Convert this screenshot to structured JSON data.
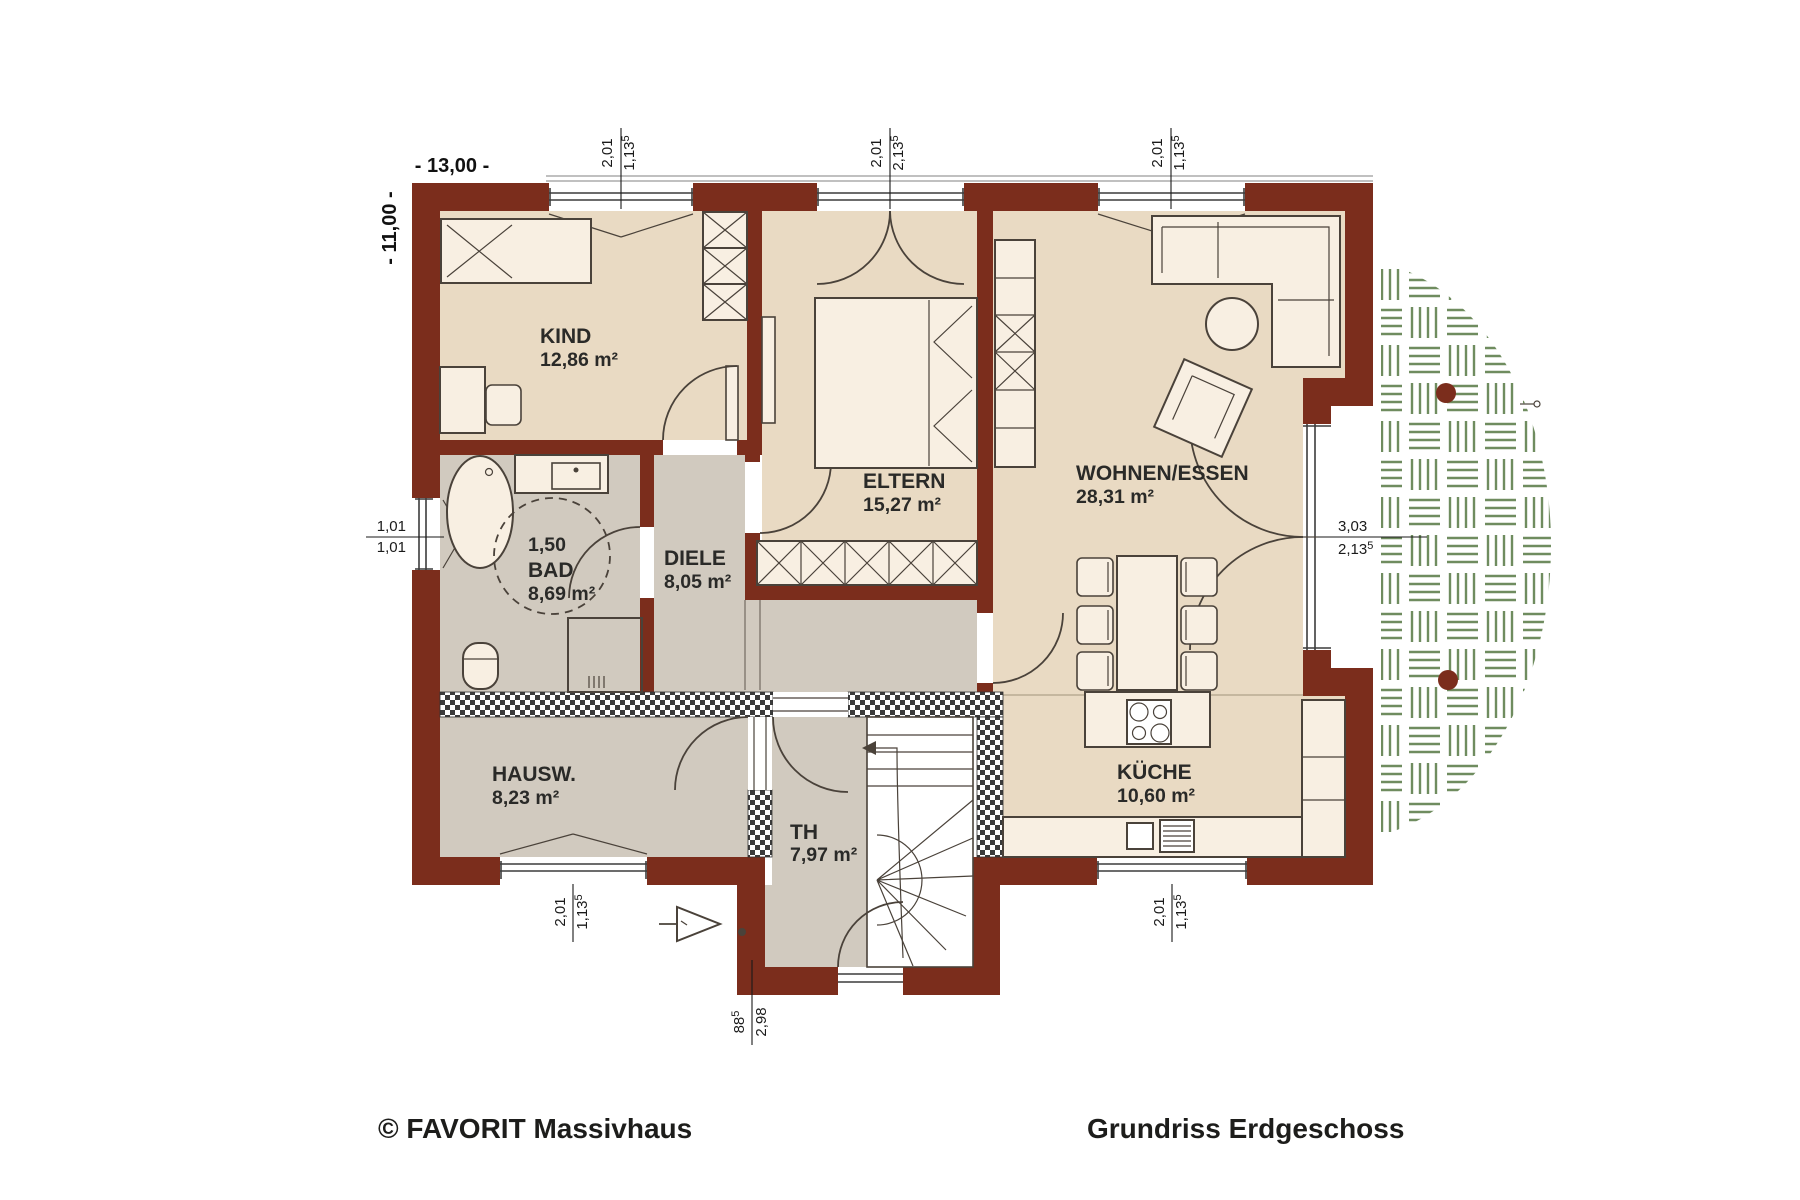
{
  "title": "Grundriss Erdgeschoss",
  "footer": {
    "left": "© FAVORIT Massivhaus",
    "right": "Grundriss Erdgeschoss"
  },
  "overall_dimensions": {
    "width": "- 13,00 -",
    "depth": "- 11,00 -"
  },
  "rooms": {
    "kind": {
      "name": "KIND",
      "area": "12,86 m²"
    },
    "eltern": {
      "name": "ELTERN",
      "area": "15,27 m²"
    },
    "wohnen": {
      "name": "WOHNEN/ESSEN",
      "area": "28,31 m²"
    },
    "bad": {
      "circle": "1,50",
      "name": "BAD",
      "area": "8,69 m²"
    },
    "diele": {
      "name": "DIELE",
      "area": "8,05 m²"
    },
    "hausw": {
      "name": "HAUSW.",
      "area": "8,23 m²"
    },
    "th": {
      "name": "TH",
      "area": "7,97 m²"
    },
    "kueche": {
      "name": "KÜCHE",
      "area": "10,60 m²"
    }
  },
  "openings": {
    "top_kind": {
      "w": "2,01",
      "h": "1,13",
      "h_sup": "5"
    },
    "top_eltern": {
      "w": "2,01",
      "h": "2,13",
      "h_sup": "5"
    },
    "top_wohnen": {
      "w": "2,01",
      "h": "1,13",
      "h_sup": "5"
    },
    "left_bad": {
      "w": "1,01",
      "h": "1,01",
      "h_sup": ""
    },
    "bottom_hausw": {
      "w": "2,01",
      "h": "1,13",
      "h_sup": "5"
    },
    "bottom_kueche": {
      "w": "2,01",
      "h": "1,13",
      "h_sup": "5"
    },
    "terrace_door": {
      "w": "3,03",
      "h": "2,13",
      "h_sup": "5"
    },
    "entry_door": {
      "w": "88",
      "w_sup": "5",
      "h": "2,98"
    }
  },
  "colors": {
    "wall": "#7b2d1c",
    "floor_cream": "#e9dac3",
    "floor_gray": "#d1cabf",
    "furniture": "#f8efe2",
    "outline": "#4a423a",
    "terrace_green": "#6f8c5f",
    "text": "#2a2a28"
  }
}
